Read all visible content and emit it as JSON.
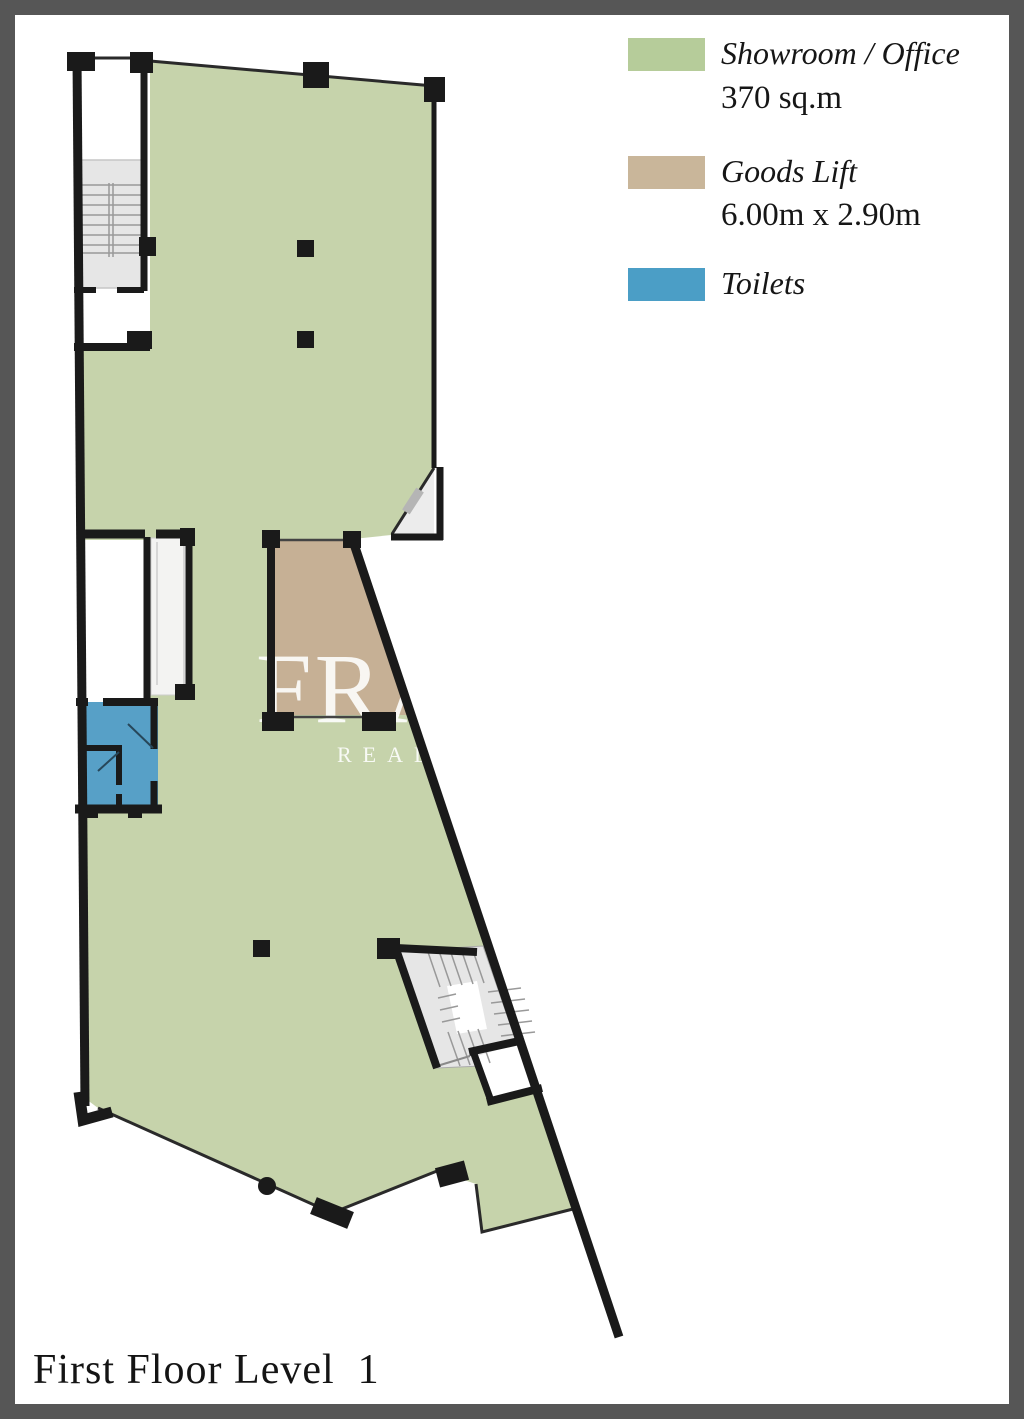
{
  "title": "First Floor Level  1",
  "legend": {
    "items": [
      {
        "label": "Showroom / Office",
        "detail": "370 sq.m"
      },
      {
        "label": "Goods Lift",
        "detail": "6.00m x 2.90m"
      },
      {
        "label": "Toilets",
        "detail": ""
      }
    ]
  },
  "watermark": {
    "line1": "FRA",
    "line2": "REAL E"
  },
  "colors": {
    "legend-green": "#b6cc9a",
    "legend-tan": "#c9b69a",
    "legend-blue": "#4b9ec6",
    "plan-green": "#c6d3ab",
    "plan-tan": "#c6b095",
    "plan-blue": "#57a0c7",
    "wall": "#1a1a1a",
    "stair-gray": "#e6e6e6",
    "shaft-gray": "#f3f3f2",
    "chamfer-gray": "#ececec",
    "frame-gray": "#565656",
    "watermark-white": "rgba(255,255,255,0.88)"
  }
}
